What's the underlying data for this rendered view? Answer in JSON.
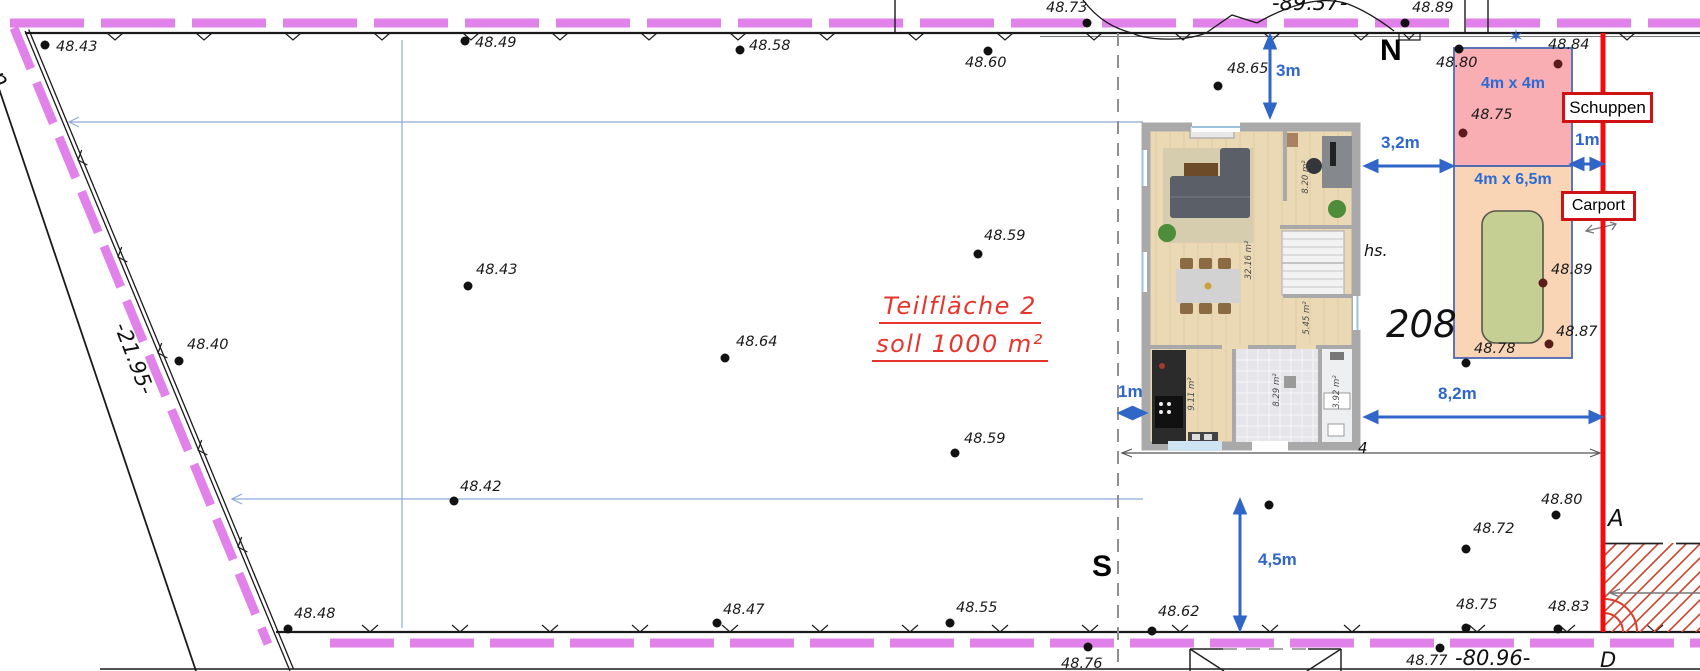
{
  "plan": {
    "north_label": "N",
    "south_label": "S",
    "ditch_label": "graben",
    "boundary_length_left": "-21.95-",
    "boundary_length_top": "-89.37-",
    "boundary_length_bottom": "-80.96-",
    "parcel_number": "208",
    "house_abbrev": "hs.",
    "marker_a": "A",
    "marker_d": "D",
    "dim_four": "4",
    "star_icon_glyph": "✶"
  },
  "area_note": {
    "line1": "Teilfläche 2",
    "line2": "soll 1000 m²"
  },
  "structures": {
    "schuppen_label": "Schuppen",
    "schuppen_size": "4m x 4m",
    "carport_label": "Carport",
    "carport_size": "4m x 6,5m"
  },
  "dimensions": [
    {
      "label": "3m",
      "x": 1276,
      "y": 62
    },
    {
      "label": "3,2m",
      "x": 1381,
      "y": 134
    },
    {
      "label": "1m",
      "x": 1575,
      "y": 131
    },
    {
      "label": "8,2m",
      "x": 1438,
      "y": 385
    },
    {
      "label": "1m",
      "x": 1118,
      "y": 383
    },
    {
      "label": "4,5m",
      "x": 1258,
      "y": 551
    }
  ],
  "floorplan_rooms": [
    {
      "label": "32.16 m²",
      "x": 1249,
      "y": 260
    },
    {
      "label": "8.20 m²",
      "x": 1306,
      "y": 177
    },
    {
      "label": "5.45 m²",
      "x": 1307,
      "y": 318
    },
    {
      "label": "9.11 m²",
      "x": 1192,
      "y": 394
    },
    {
      "label": "8.29 m²",
      "x": 1277,
      "y": 390
    },
    {
      "label": "3.92 m²",
      "x": 1337,
      "y": 392
    }
  ],
  "elevation_points": [
    {
      "v": "48.43",
      "lx": 56,
      "ly": 40,
      "dx": 45,
      "dy": 45,
      "c": "k"
    },
    {
      "v": "48.49",
      "lx": 475,
      "ly": 36,
      "dx": 465,
      "dy": 41,
      "c": "k"
    },
    {
      "v": "48.58",
      "lx": 749,
      "ly": 39,
      "dx": 740,
      "dy": 50,
      "c": "k"
    },
    {
      "v": "48.60",
      "lx": 965,
      "ly": 56,
      "dx": 988,
      "dy": 51,
      "c": "k"
    },
    {
      "v": "48.73",
      "lx": 1046,
      "ly": 1,
      "dx": 1087,
      "dy": 23,
      "c": "k"
    },
    {
      "v": "48.65",
      "lx": 1227,
      "ly": 62,
      "dx": 1218,
      "dy": 86,
      "c": "k"
    },
    {
      "v": "48.89",
      "lx": 1412,
      "ly": 1,
      "dx": 1405,
      "dy": 23,
      "c": "k"
    },
    {
      "v": "48.80",
      "lx": 1436,
      "ly": 56,
      "dx": 1459,
      "dy": 49,
      "c": "k"
    },
    {
      "v": "48.84",
      "lx": 1548,
      "ly": 38,
      "dx": 1558,
      "dy": 64,
      "c": "m"
    },
    {
      "v": "48.75",
      "lx": 1471,
      "ly": 108,
      "dx": 1463,
      "dy": 133,
      "c": "m"
    },
    {
      "v": "48.43",
      "lx": 476,
      "ly": 263,
      "dx": 468,
      "dy": 286,
      "c": "k"
    },
    {
      "v": "48.40",
      "lx": 187,
      "ly": 338,
      "dx": 179,
      "dy": 361,
      "c": "k"
    },
    {
      "v": "48.59",
      "lx": 984,
      "ly": 229,
      "dx": 978,
      "dy": 254,
      "c": "k"
    },
    {
      "v": "48.64",
      "lx": 736,
      "ly": 335,
      "dx": 725,
      "dy": 358,
      "c": "k"
    },
    {
      "v": "48.59",
      "lx": 964,
      "ly": 432,
      "dx": 955,
      "dy": 453,
      "c": "k"
    },
    {
      "v": "48.42",
      "lx": 460,
      "ly": 480,
      "dx": 454,
      "dy": 501,
      "c": "k"
    },
    {
      "v": "48.89",
      "lx": 1551,
      "ly": 263,
      "dx": 1543,
      "dy": 283,
      "c": "m"
    },
    {
      "v": "48.87",
      "lx": 1556,
      "ly": 325,
      "dx": 1549,
      "dy": 344,
      "c": "m"
    },
    {
      "v": "48.78",
      "lx": 1474,
      "ly": 342,
      "dx": 1466,
      "dy": 363,
      "c": "k"
    },
    {
      "v": "48.48",
      "lx": 294,
      "ly": 607,
      "dx": 288,
      "dy": 629,
      "c": "k"
    },
    {
      "v": "48.47",
      "lx": 723,
      "ly": 603,
      "dx": 717,
      "dy": 623,
      "c": "k"
    },
    {
      "v": "48.55",
      "lx": 956,
      "ly": 601,
      "dx": 950,
      "dy": 623,
      "c": "k"
    },
    {
      "v": "48.62",
      "lx": 1158,
      "ly": 605,
      "dx": 1152,
      "dy": 631,
      "c": "k"
    },
    {
      "v": "48.76",
      "lx": 1061,
      "ly": 657,
      "dx": 1088,
      "dy": 647,
      "c": "k"
    },
    {
      "v": "48.77",
      "lx": 1406,
      "ly": 654,
      "dx": 1440,
      "dy": 648,
      "c": "k"
    },
    {
      "v": "48.75",
      "lx": 1456,
      "ly": 598,
      "dx": 1466,
      "dy": 628,
      "c": "k"
    },
    {
      "v": "48.83",
      "lx": 1548,
      "ly": 600,
      "dx": 1558,
      "dy": 629,
      "c": "k"
    },
    {
      "v": "48.72",
      "lx": 1473,
      "ly": 522,
      "dx": 1466,
      "dy": 549,
      "c": "k"
    },
    {
      "v": "48.80",
      "lx": 1541,
      "ly": 493,
      "dx": 1556,
      "dy": 515,
      "c": "k"
    },
    {
      "v": "",
      "lx": 0,
      "ly": 0,
      "dx": 1269,
      "dy": 505,
      "c": "k"
    }
  ],
  "colors": {
    "boundary_purple": "#e182eb",
    "dimension_blue": "#2f66cc",
    "red_line": "#f40b0b",
    "note_red": "#e8352c",
    "hatch_red": "#d4402e",
    "schuppen_fill": "#f5a2aa",
    "carport_fill": "#f8d3b3",
    "car_green": "#c6cf93"
  }
}
